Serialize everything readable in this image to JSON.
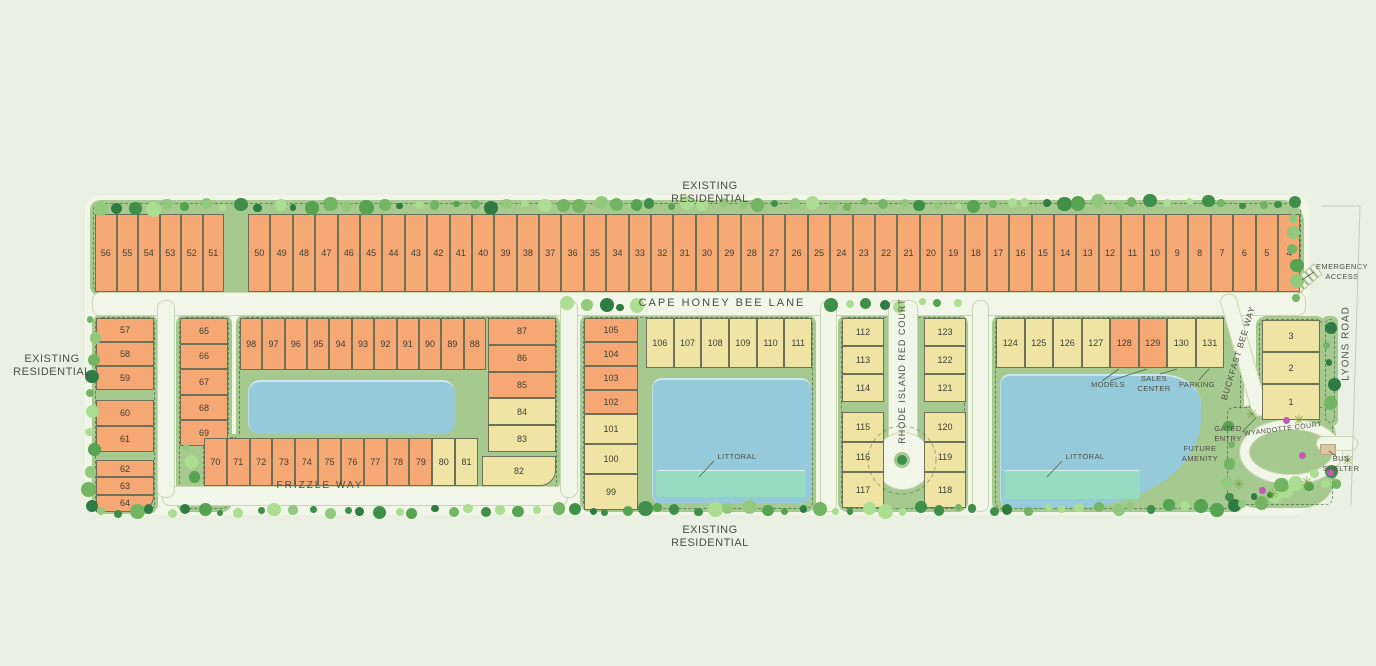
{
  "labels": {
    "existing_residential": "EXISTING RESIDENTIAL"
  },
  "streets": {
    "cape_honey_bee_lane": "CAPE HONEY BEE LANE",
    "frizzle_way": "FRIZZLE WAY",
    "rhode_island_red_court": "RHODE ISLAND RED COURT",
    "buckfast_bee_way": "BUCKFAST BEE WAY",
    "wyandotte_court": "WYANDOTTE COURT",
    "lyons_road": "LYONS ROAD"
  },
  "annotations": {
    "emergency_access": "EMERGENCY ACCESS",
    "models": "MODELS",
    "sales_center": "SALES CENTER",
    "parking": "PARKING",
    "gated_entry": "GATED ENTRY",
    "bus_shelter": "BUS SHELTER",
    "future_amenity": "FUTURE AMENITY",
    "littoral": "LITTORAL"
  },
  "colors": {
    "background": "#EAF1E2",
    "pavement": "#F2F6E8",
    "green_band": "#A5C98F",
    "lot_orange": "#F5A873",
    "lot_yellow": "#F0E4A4",
    "lake": "#95CADA",
    "littoral": "#97DCC2",
    "text": "#4B4F44",
    "shrub_magenta": "#C05AB4",
    "palm": "#7DA23F"
  },
  "lot_groups": [
    {
      "id": "top_west",
      "fill": "orange",
      "numbers": [
        56,
        55,
        54,
        53,
        52,
        51
      ]
    },
    {
      "id": "top_main",
      "fill": "orange",
      "numbers": [
        50,
        49,
        48,
        47,
        46,
        45,
        44,
        43,
        42,
        41,
        40,
        39,
        38,
        37,
        36,
        35,
        34,
        33,
        32,
        31,
        30,
        29,
        28,
        27,
        26,
        25,
        24,
        23,
        22,
        21,
        20,
        19,
        18,
        17,
        16,
        15,
        14,
        13,
        12,
        11,
        10,
        9,
        8,
        7,
        6,
        5,
        4
      ]
    },
    {
      "id": "left_a",
      "fill": "orange",
      "numbers": [
        57,
        58,
        59
      ]
    },
    {
      "id": "left_b",
      "fill": "orange",
      "numbers": [
        60,
        61
      ]
    },
    {
      "id": "left_c",
      "fill": "orange",
      "numbers": [
        62,
        63,
        64
      ]
    },
    {
      "id": "col65",
      "fill": "orange",
      "numbers": [
        65,
        66,
        67,
        68,
        69
      ]
    },
    {
      "id": "b1_top",
      "fill": "orange",
      "numbers": [
        98,
        97,
        96,
        95,
        94,
        93,
        92,
        91,
        90,
        89,
        88
      ]
    },
    {
      "id": "b1_right",
      "fills": [
        "orange",
        "orange",
        "orange",
        "yellow",
        "yellow"
      ],
      "numbers": [
        87,
        86,
        85,
        84,
        83
      ]
    },
    {
      "id": "b1_corner",
      "fill": "yellow",
      "numbers": [
        82
      ]
    },
    {
      "id": "b1_bottom",
      "fills": [
        "orange",
        "orange",
        "orange",
        "orange",
        "orange",
        "orange",
        "orange",
        "orange",
        "orange",
        "orange",
        "yellow",
        "yellow"
      ],
      "numbers": [
        70,
        71,
        72,
        73,
        74,
        75,
        76,
        77,
        78,
        79,
        80,
        81
      ]
    },
    {
      "id": "b2_left",
      "fills": [
        "orange",
        "orange",
        "orange",
        "orange",
        "yellow",
        "yellow",
        "yellow"
      ],
      "numbers": [
        105,
        104,
        103,
        102,
        101,
        100,
        99
      ]
    },
    {
      "id": "b2_top",
      "fill": "yellow",
      "numbers": [
        106,
        107,
        108,
        109,
        110,
        111
      ]
    },
    {
      "id": "mid_l_top",
      "fill": "yellow",
      "numbers": [
        112,
        113,
        114
      ]
    },
    {
      "id": "mid_l_bot",
      "fill": "yellow",
      "numbers": [
        115,
        116,
        117
      ]
    },
    {
      "id": "mid_r_top",
      "fill": "yellow",
      "numbers": [
        123,
        122,
        121
      ]
    },
    {
      "id": "mid_r_bot",
      "fill": "yellow",
      "numbers": [
        120,
        119,
        118
      ]
    },
    {
      "id": "b3_top",
      "fills": [
        "yellow",
        "yellow",
        "yellow",
        "yellow",
        "orange",
        "orange",
        "yellow",
        "yellow"
      ],
      "numbers": [
        124,
        125,
        126,
        127,
        128,
        129,
        130,
        131
      ]
    },
    {
      "id": "right_col",
      "fill": "yellow",
      "numbers": [
        3,
        2,
        1
      ]
    }
  ]
}
